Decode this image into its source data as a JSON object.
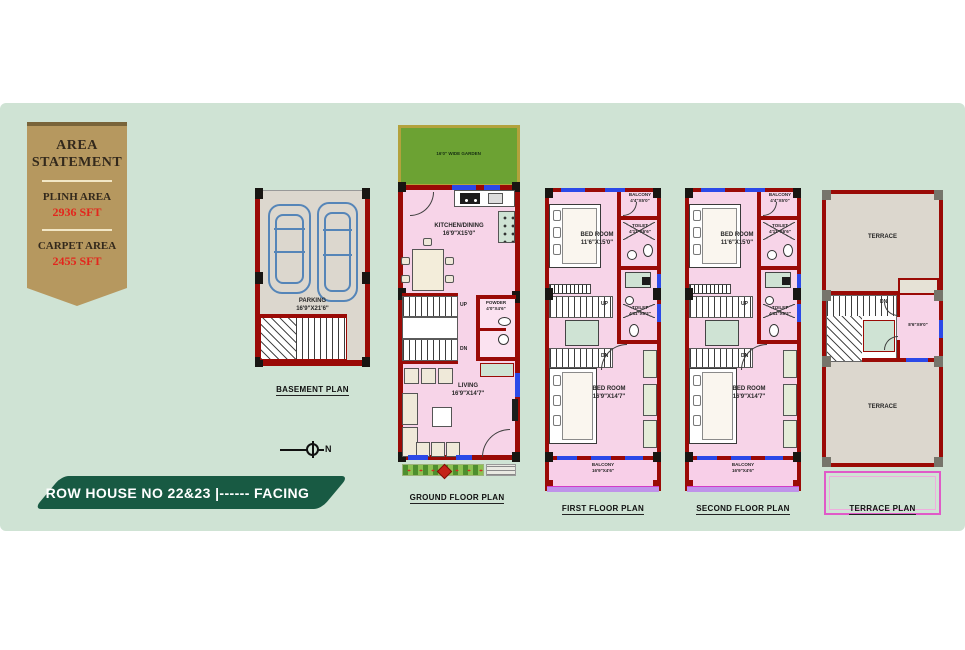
{
  "colors": {
    "panel": "#cfe3d4",
    "ribbon": "#b6985f",
    "ribbon_red": "#e3261d",
    "banner": "#185a43",
    "wall": "#9a0a06",
    "window_blue": "#2b49e8",
    "garden_green": "#6ca233",
    "floor_pink": "#f7d4e8"
  },
  "ribbon": {
    "title": "AREA STATEMENT",
    "plinth_label": "PLINH AREA",
    "plinth_value": "2936 SFT",
    "carpet_label": "CARPET AREA",
    "carpet_value": "2455 SFT"
  },
  "banner": {
    "text": "ROW HOUSE NO 22&23  |------ FACING"
  },
  "compass": {
    "north": "N"
  },
  "plans": {
    "basement": {
      "caption": "BASEMENT PLAN",
      "parking": "PARKING",
      "parking_dims": "16'9\"X21'6\""
    },
    "ground": {
      "caption": "GROUND FLOOR PLAN",
      "garden": "16'0\" WIDE GARDEN",
      "kitchen": "KITCHEN/DINING",
      "kitchen_dims": "16'9\"X15'0\"",
      "powder": "POWDER",
      "powder_dims": "4'0\"X4'6\"",
      "living": "LIVING",
      "living_dims": "16'9\"X14'7\"",
      "up": "UP",
      "dn": "DN"
    },
    "first": {
      "caption": "FIRST FLOOR PLAN",
      "bedroom1": "BED ROOM",
      "bedroom1_dims": "11'6\"X15'0\"",
      "balcony1": "BALCONY",
      "balcony1_dims": "4'4\"X5'0\"",
      "toilet1": "TOILET",
      "toilet1_dims": "4'11\"X6'6\"",
      "toilet2": "TOILET",
      "toilet2_dims": "4'11\"X6'2\"",
      "bedroom2": "BED ROOM",
      "bedroom2_dims": "16'9\"X14'7\"",
      "balcony2": "BALCONY",
      "balcony2_dims": "16'9\"X4'6\"",
      "up": "UP",
      "dn": "DN"
    },
    "second": {
      "caption": "SECOND FLOOR PLAN",
      "bedroom1": "BED ROOM",
      "bedroom1_dims": "11'6\"X15'0\"",
      "balcony1": "BALCONY",
      "balcony1_dims": "4'4\"X5'0\"",
      "toilet1": "TOILET",
      "toilet1_dims": "4'11\"X6'6\"",
      "toilet2": "TOILET",
      "toilet2_dims": "4'11\"X6'2\"",
      "bedroom2": "BED ROOM",
      "bedroom2_dims": "16'9\"X14'7\"",
      "balcony2": "BALCONY",
      "balcony2_dims": "16'9\"X4'6\"",
      "up": "UP",
      "dn": "DN"
    },
    "terrace": {
      "caption": "TERRACE PLAN",
      "terrace_top": "TERRACE",
      "terrace_bottom": "TERRACE",
      "headroom_dims": "8'6\"X9'0\"",
      "dn": "DN"
    }
  }
}
